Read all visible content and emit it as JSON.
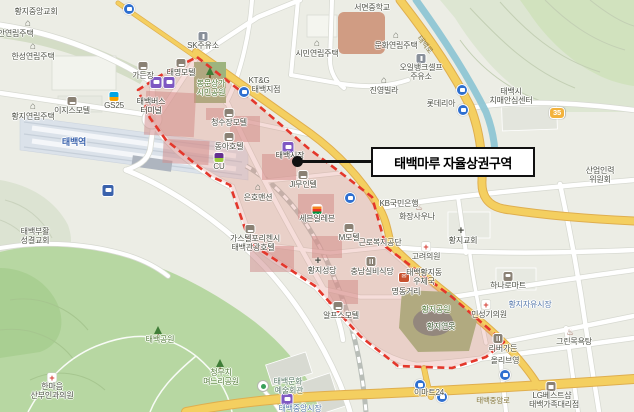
{
  "map": {
    "callout": {
      "label": "태백마루 자율상권구역"
    },
    "colors": {
      "district_fill": "#e18d85",
      "district_border": "#e4372b",
      "road_major_yellow": "#f4cf60",
      "water": "#8fc6d4",
      "park_green": "#b7d7a2",
      "callout_border": "#101010",
      "transit_badge_purple": "#7e57c2",
      "bus_stop_blue": "#2e6fd0"
    },
    "labels": [
      {
        "t": "황지중앙교회",
        "x": 36,
        "y": 7,
        "c": ""
      },
      {
        "t": "동안연립주택",
        "x": 12,
        "y": 29,
        "c": ""
      },
      {
        "t": "한성연립주택",
        "x": 33,
        "y": 52,
        "c": ""
      },
      {
        "t": "황지연립주택",
        "x": 33,
        "y": 112,
        "c": ""
      },
      {
        "t": "이지스모텔",
        "x": 72,
        "y": 106,
        "c": ""
      },
      {
        "t": "GS25",
        "x": 114,
        "y": 101,
        "c": ""
      },
      {
        "t": "태백역",
        "x": 74,
        "y": 138,
        "c": "st"
      },
      {
        "t": "가든장",
        "x": 143,
        "y": 71,
        "c": ""
      },
      {
        "t": "태명모텔",
        "x": 181,
        "y": 68,
        "c": ""
      },
      {
        "t": "태백버스",
        "x": 151,
        "y": 97,
        "c": "dk"
      },
      {
        "t": "터미널",
        "x": 151,
        "y": 106,
        "c": "dk"
      },
      {
        "t": "SK주유소",
        "x": 203,
        "y": 41,
        "c": ""
      },
      {
        "t": "봉문상가",
        "x": 211,
        "y": 79,
        "c": "grn"
      },
      {
        "t": "시민공원",
        "x": 211,
        "y": 88,
        "c": "grn"
      },
      {
        "t": "시민연립주택",
        "x": 317,
        "y": 49,
        "c": ""
      },
      {
        "t": "서면중학교",
        "x": 372,
        "y": 3,
        "c": ""
      },
      {
        "t": "문화연립주택",
        "x": 396,
        "y": 41,
        "c": ""
      },
      {
        "t": "오일뱅크셀프",
        "x": 421,
        "y": 63,
        "c": ""
      },
      {
        "t": "주유소",
        "x": 421,
        "y": 72,
        "c": ""
      },
      {
        "t": "진영빌라",
        "x": 384,
        "y": 86,
        "c": ""
      },
      {
        "t": "태백로",
        "x": 425,
        "y": 40,
        "c": "road rot"
      },
      {
        "t": "롯데리아",
        "x": 441,
        "y": 99,
        "c": ""
      },
      {
        "t": "태백시",
        "x": 511,
        "y": 87,
        "c": ""
      },
      {
        "t": "치매안심센터",
        "x": 511,
        "y": 96,
        "c": ""
      },
      {
        "t": "산업인력",
        "x": 600,
        "y": 166,
        "c": ""
      },
      {
        "t": "위원회",
        "x": 600,
        "y": 175,
        "c": ""
      },
      {
        "t": "35",
        "x": 557,
        "y": 107,
        "c": "shield"
      },
      {
        "t": "KT&G",
        "x": 259,
        "y": 76,
        "c": ""
      },
      {
        "t": "태백지점",
        "x": 266,
        "y": 85,
        "c": ""
      },
      {
        "t": "청수장모텔",
        "x": 229,
        "y": 118,
        "c": ""
      },
      {
        "t": "동아호텔",
        "x": 229,
        "y": 142,
        "c": ""
      },
      {
        "t": "CU",
        "x": 219,
        "y": 162,
        "c": ""
      },
      {
        "t": "태백시장",
        "x": 290,
        "y": 151,
        "c": "dk"
      },
      {
        "t": "JI무인텔",
        "x": 303,
        "y": 180,
        "c": ""
      },
      {
        "t": "은호맨션",
        "x": 258,
        "y": 193,
        "c": ""
      },
      {
        "t": "KB국민은행",
        "x": 399,
        "y": 199,
        "c": ""
      },
      {
        "t": "세븐일레븐",
        "x": 317,
        "y": 214,
        "c": ""
      },
      {
        "t": "근로복지공단",
        "x": 380,
        "y": 238,
        "c": ""
      },
      {
        "t": "가스텔포리첸시",
        "x": 255,
        "y": 234,
        "c": ""
      },
      {
        "t": "태백관광호텔",
        "x": 253,
        "y": 243,
        "c": ""
      },
      {
        "t": "M모텔",
        "x": 349,
        "y": 233,
        "c": ""
      },
      {
        "t": "황지성당",
        "x": 322,
        "y": 266,
        "c": ""
      },
      {
        "t": "충남실비식당",
        "x": 372,
        "y": 267,
        "c": ""
      },
      {
        "t": "고려의원",
        "x": 426,
        "y": 252,
        "c": ""
      },
      {
        "t": "태백황지동",
        "x": 424,
        "y": 268,
        "c": ""
      },
      {
        "t": "우체국",
        "x": 424,
        "y": 277,
        "c": ""
      },
      {
        "t": "화장사우나",
        "x": 417,
        "y": 212,
        "c": ""
      },
      {
        "t": "황지교회",
        "x": 463,
        "y": 236,
        "c": ""
      },
      {
        "t": "명동거리",
        "x": 406,
        "y": 287,
        "c": ""
      },
      {
        "t": "하나로마트",
        "x": 508,
        "y": 281,
        "c": ""
      },
      {
        "t": "황지자유시장",
        "x": 530,
        "y": 300,
        "c": "mkt"
      },
      {
        "t": "그린목욕탕",
        "x": 574,
        "y": 337,
        "c": ""
      },
      {
        "t": "민성기의원",
        "x": 489,
        "y": 310,
        "c": ""
      },
      {
        "t": "리버가든",
        "x": 503,
        "y": 344,
        "c": ""
      },
      {
        "t": "올리브영",
        "x": 505,
        "y": 356,
        "c": ""
      },
      {
        "t": "황지공원",
        "x": 436,
        "y": 305,
        "c": "grn"
      },
      {
        "t": "황지연못",
        "x": 441,
        "y": 322,
        "c": "pond"
      },
      {
        "t": "이마트24",
        "x": 429,
        "y": 388,
        "c": ""
      },
      {
        "t": "태백중앙로",
        "x": 493,
        "y": 396,
        "c": "road"
      },
      {
        "t": "태백중앙시장",
        "x": 300,
        "y": 404,
        "c": "mkt"
      },
      {
        "t": "LG베스트샵",
        "x": 552,
        "y": 391,
        "c": ""
      },
      {
        "t": "태백가족대리점",
        "x": 554,
        "y": 400,
        "c": ""
      },
      {
        "t": "한마음",
        "x": 52,
        "y": 382,
        "c": ""
      },
      {
        "t": "산부인과의원",
        "x": 52,
        "y": 391,
        "c": ""
      },
      {
        "t": "태백공원",
        "x": 160,
        "y": 335,
        "c": "grn"
      },
      {
        "t": "청무치",
        "x": 221,
        "y": 368,
        "c": "grn"
      },
      {
        "t": "며느리공원",
        "x": 221,
        "y": 377,
        "c": "grn"
      },
      {
        "t": "태백문화",
        "x": 288,
        "y": 377,
        "c": "fac"
      },
      {
        "t": "예술회관",
        "x": 289,
        "y": 386,
        "c": "fac"
      },
      {
        "t": "알프스모텔",
        "x": 341,
        "y": 311,
        "c": ""
      },
      {
        "t": "태백부활",
        "x": 35,
        "y": 227,
        "c": ""
      },
      {
        "t": "성결교회",
        "x": 35,
        "y": 236,
        "c": ""
      }
    ],
    "icons": [
      {
        "c": "bus",
        "x": 129,
        "y": 3
      },
      {
        "c": "home",
        "x": 28,
        "y": 20
      },
      {
        "c": "home",
        "x": 33,
        "y": 43
      },
      {
        "c": "home",
        "x": 33,
        "y": 103
      },
      {
        "c": "bed",
        "x": 72,
        "y": 97
      },
      {
        "c": "gs",
        "x": 114,
        "y": 92
      },
      {
        "c": "train",
        "x": 108,
        "y": 184
      },
      {
        "c": "bed",
        "x": 143,
        "y": 62
      },
      {
        "c": "bed",
        "x": 181,
        "y": 59
      },
      {
        "c": "term",
        "x": 156,
        "y": 76
      },
      {
        "c": "term",
        "x": 169,
        "y": 76
      },
      {
        "c": "gas",
        "x": 203,
        "y": 32
      },
      {
        "c": "tree",
        "x": 210,
        "y": 67
      },
      {
        "c": "home",
        "x": 317,
        "y": 40
      },
      {
        "c": "home",
        "x": 396,
        "y": 32
      },
      {
        "c": "gas",
        "x": 421,
        "y": 54
      },
      {
        "c": "home",
        "x": 384,
        "y": 77
      },
      {
        "c": "bus",
        "x": 462,
        "y": 84
      },
      {
        "c": "bus",
        "x": 463,
        "y": 104
      },
      {
        "c": "bed",
        "x": 229,
        "y": 109
      },
      {
        "c": "bed",
        "x": 229,
        "y": 133
      },
      {
        "c": "cu",
        "x": 219,
        "y": 153
      },
      {
        "c": "term",
        "x": 288,
        "y": 141
      },
      {
        "c": "bed",
        "x": 303,
        "y": 171
      },
      {
        "c": "home",
        "x": 258,
        "y": 184
      },
      {
        "c": "bus",
        "x": 244,
        "y": 86
      },
      {
        "c": "bus",
        "x": 350,
        "y": 192
      },
      {
        "c": "sev",
        "x": 317,
        "y": 205
      },
      {
        "c": "bed",
        "x": 250,
        "y": 225
      },
      {
        "c": "bed",
        "x": 349,
        "y": 224
      },
      {
        "c": "church",
        "x": 318,
        "y": 256
      },
      {
        "c": "food",
        "x": 371,
        "y": 257
      },
      {
        "c": "post",
        "x": 404,
        "y": 273
      },
      {
        "c": "crossr",
        "x": 426,
        "y": 242
      },
      {
        "c": "sauna",
        "x": 419,
        "y": 202
      },
      {
        "c": "church",
        "x": 461,
        "y": 226
      },
      {
        "c": "cart",
        "x": 508,
        "y": 272
      },
      {
        "c": "sauna",
        "x": 570,
        "y": 327
      },
      {
        "c": "crossr",
        "x": 486,
        "y": 300
      },
      {
        "c": "food",
        "x": 498,
        "y": 334
      },
      {
        "c": "bus",
        "x": 420,
        "y": 379
      },
      {
        "c": "bus",
        "x": 442,
        "y": 391
      },
      {
        "c": "bus",
        "x": 505,
        "y": 369
      },
      {
        "c": "term",
        "x": 287,
        "y": 393
      },
      {
        "c": "store",
        "x": 551,
        "y": 382
      },
      {
        "c": "crossr",
        "x": 52,
        "y": 373
      },
      {
        "c": "tree",
        "x": 158,
        "y": 326
      },
      {
        "c": "tree",
        "x": 220,
        "y": 359
      },
      {
        "c": "pin",
        "x": 263,
        "y": 380
      },
      {
        "c": "bed",
        "x": 338,
        "y": 302
      }
    ]
  }
}
